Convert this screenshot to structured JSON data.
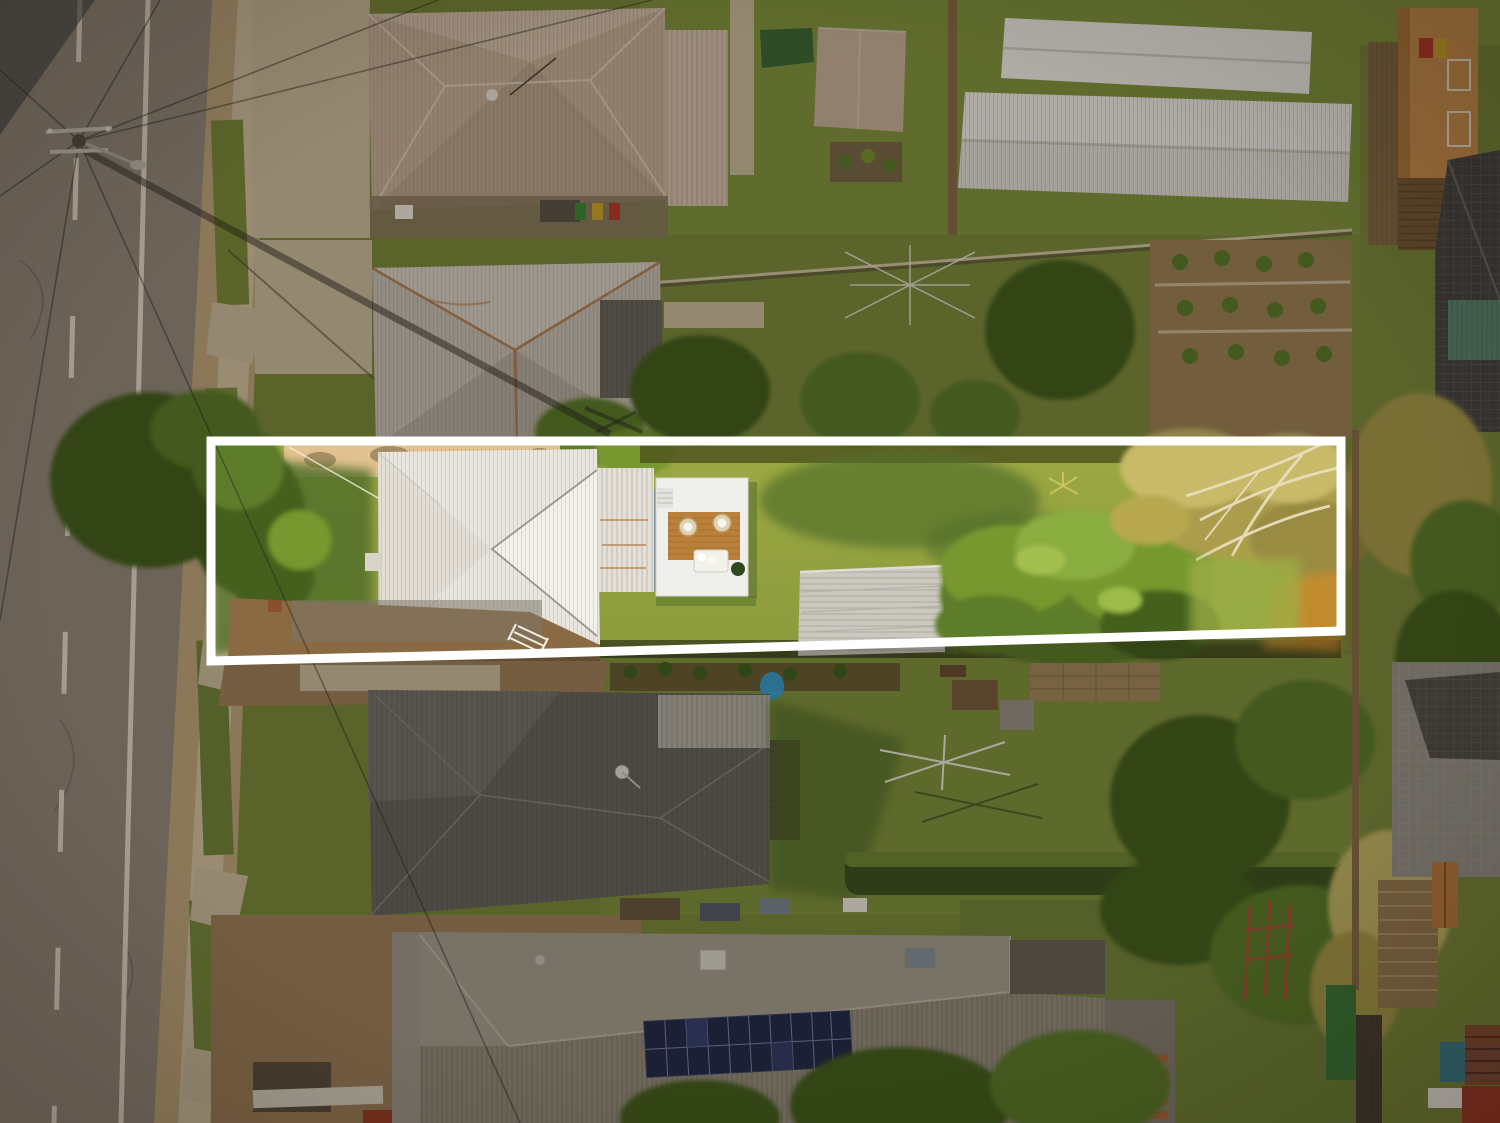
{
  "image": {
    "type": "aerial-drone-photograph",
    "subject": "bird's-eye view of a suburban street; one long residential lot is highlighted with a white boundary outline, surroundings are dimmed",
    "width_px": 1500,
    "height_px": 1123,
    "visible_text": ""
  },
  "boundary": {
    "points": "211,441 1341,441 1341,631 515,654 211,661",
    "stroke_width": 9,
    "color": "#ffffff",
    "dim_path": "M0,0H1500V1123H0Z M211,441L1341,441L1341,631L515,654L211,661Z",
    "dim_opacity": 0.3
  },
  "scene": {
    "highlighted_lot": [
      "white-corrugated-hip-roof-house",
      "rear-deck-with-timber-inlay-and-outdoor-furniture",
      "grey-garden-shed",
      "large-green-tree",
      "dry-olive-tree-with-white-branches",
      "sunlit-lawn"
    ],
    "surroundings": [
      "asphalt-road-with-lane-markings",
      "power-pole-with-wires-and-long-shadow",
      "footpath-and-grass-verge",
      "taupe-hip-roof-house",
      "grey-hip-roof-house-with-rust",
      "white-gable-roofed-buildings",
      "dark-grey-hip-roof-house",
      "house-with-solar-panel-array",
      "hedges-trees-clotheslines",
      "neighbouring-terracotta-and-teal-roofs"
    ]
  },
  "palette": {
    "road": "#998d7e",
    "roadline": "#eadfcc",
    "verge": "#c3a97f",
    "sidewalk": "#d9c6a4",
    "concrete": "#d2c0a0",
    "dirt": "#a3835c",
    "dirtdark": "#8a6a43",
    "grass": "#86983f",
    "grassyard": "#7d8c3c",
    "grassshadow": "#53702c",
    "tree1": "#44601f",
    "tree2": "#5d7d2a",
    "tree3": "#76982f",
    "tree4": "#8aad3f",
    "olive1": "#ab9d4c",
    "olive2": "#c8ba68",
    "branch": "#eadfbd",
    "roofA": "#cdb59e",
    "roofAlight": "#dcc6b0",
    "roofB": "#cfc6b9",
    "roofBlight": "#ded6c9",
    "rust": "#b5713c",
    "roofdarkB": "#6e6a62",
    "roofwhite": "#e9e6df",
    "roofwhitelight": "#f3f1ec",
    "deck": "#eff0ec",
    "timber": "#b9803a",
    "shed": "#ccc8c0",
    "roofC": "#6b6862",
    "roofClight": "#7d7971",
    "roofD": "#aaa193",
    "roofDdark": "#98907f",
    "wall": "#a59d91",
    "solar": "#252b4a",
    "solarline": "#8d97c9",
    "white": "#f2ede2",
    "terracotta": "#b26a3a",
    "orangehouse": "#cf9350",
    "tealroof": "#5d8a72",
    "darktile": "#4a4644",
    "fencebrown": "#8a6f46",
    "hedge": "#3e5520",
    "hedgelight": "#718936",
    "orange": "#c8892f",
    "bluetarp": "#35a7e0",
    "binGreen": "#3f8a36",
    "binYellow": "#d1a72e",
    "binRed": "#c03a2a",
    "playRed": "#b05038",
    "poolTeal": "#3f7d8a",
    "redRoof": "#a33c28",
    "bigWhiteRoof": "#f6f3ed"
  }
}
